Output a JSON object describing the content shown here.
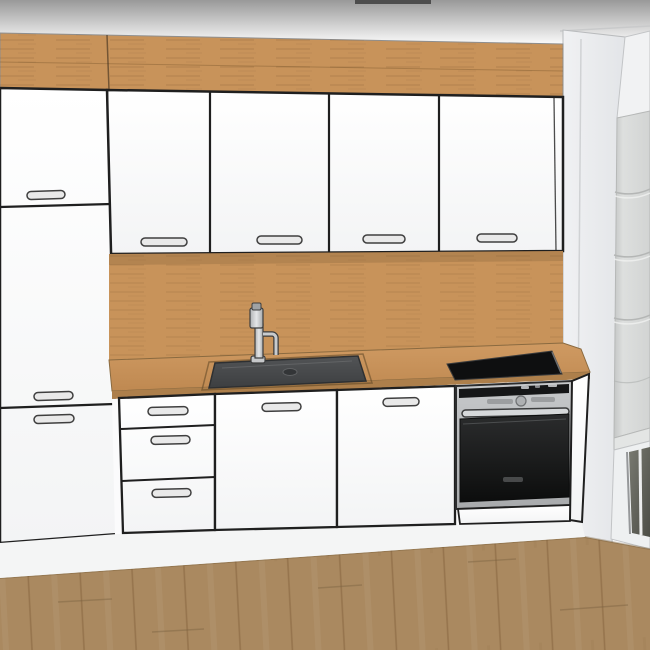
{
  "scene": {
    "type": "3d-kitchen-render",
    "objects": [
      "tall-fridge-cabinet",
      "upper-cabinet-row-4-doors",
      "wood-soffit-panel",
      "wood-backsplash-panel",
      "wood-countertop",
      "drawer-unit-3-drawers",
      "sink-base-door",
      "dishwasher-door",
      "built-in-oven",
      "induction-cooktop",
      "undermount-sink",
      "mixer-faucet",
      "window-roman-blind",
      "wood-plank-floor",
      "right-wall-column"
    ],
    "counts": {
      "upper_doors": 4,
      "tall_unit_doors": 3,
      "drawers": 3,
      "base_doors": 2,
      "handles": 12
    }
  },
  "colors": {
    "ceiling_top": "#9a9a9a",
    "top_bar": "#4d4d4d",
    "wood": "#c8935a",
    "wood_grain": "#8a6234",
    "counter_top": "#c6925c",
    "counter_edge": "#ad7f4b",
    "cabinet_face": "#fdfdfd",
    "outline": "#1f1f1f",
    "handle_fill": "#e9e9e9",
    "handle_stroke": "#3f3f3f",
    "sink_basin": "#47494b",
    "faucet_steel": "#c6c8ca",
    "cooktop": "#0e0f10",
    "oven_steel": "#b9bbbd",
    "oven_panel_dark": "#151617",
    "oven_door": "#1d1e1f",
    "wall": "#eceef0",
    "wall_shadow": "#d0d2d4",
    "blind": "#d9dbda",
    "blind_fold": "#b4b6b5",
    "glass": "#62635c",
    "floor": "#aa8960",
    "floor_line": "#7d6342"
  }
}
